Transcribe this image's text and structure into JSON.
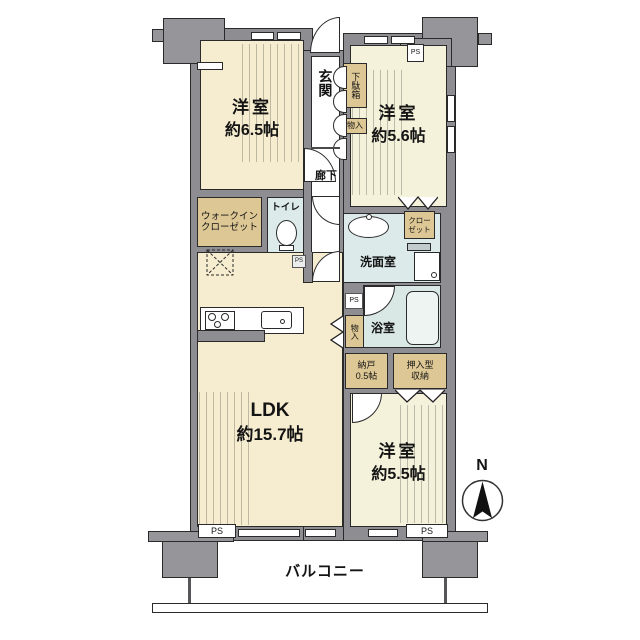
{
  "colors": {
    "wall_gray": "#8e8e92",
    "structure_gray": "#96969a",
    "storage_tan": "#ddc795",
    "ldk_cream": "#f6edd0",
    "room_pale": "#f4f2da",
    "wet_area_blue": "#ddeaea",
    "bath_blue": "#d9e7e5",
    "outline": "#2a2a2a"
  },
  "rooms": {
    "room65": {
      "name": "洋室",
      "size": "約6.5帖"
    },
    "room56": {
      "name": "洋室",
      "size": "約5.6帖"
    },
    "room55": {
      "name": "洋室",
      "size": "約5.5帖"
    },
    "ldk": {
      "name": "LDK",
      "size": "約15.7帖"
    },
    "genkan": "玄関",
    "rouka": "廊下",
    "getabako": "下駄箱",
    "monoire_upper": "物入",
    "monoire_lower": "物入",
    "wic": {
      "line1": "ウォークイン",
      "line2": "クローゼット"
    },
    "toilet": "トイレ",
    "senmen": "洗面室",
    "closet": {
      "line1": "クロー",
      "line2": "ゼット"
    },
    "bath": "浴室",
    "nando": {
      "line1": "納戸",
      "line2": "0.5帖"
    },
    "oshiire": {
      "line1": "押入型",
      "line2": "収納"
    },
    "balcony": "バルコニー"
  },
  "labels": {
    "ps": "PS",
    "north": "N"
  }
}
